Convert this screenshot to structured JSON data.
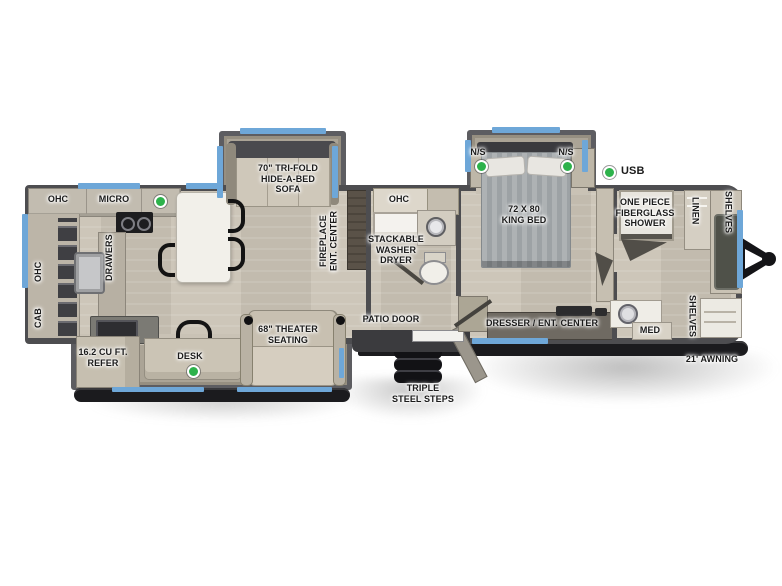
{
  "colors": {
    "window": "#6ea7d8",
    "indicator": "#2db24b",
    "wall": "#4d4d50",
    "chassis": "#1b1b1e"
  },
  "legend": {
    "usb": "USB"
  },
  "exterior": {
    "awning": "21' AWNING",
    "steps": "TRIPLE\nSTEEL STEPS",
    "patio_door": "PATIO DOOR"
  },
  "kitchen": {
    "ohc_top": "OHC",
    "micro": "MICRO",
    "ohc_side": "OHC",
    "cab": "CAB",
    "drawers": "DRAWERS",
    "refer": "16.2 CU FT.\nREFER",
    "desk": "DESK"
  },
  "living": {
    "sofa": "70\" TRI-FOLD\nHIDE-A-BED\nSOFA",
    "fireplace": "FIREPLACE\nENT. CENTER",
    "theater": "68\" THEATER\nSEATING"
  },
  "bath": {
    "ohc": "OHC",
    "washer": "STACKABLE\nWASHER\nDRYER"
  },
  "bedroom": {
    "bed": "72 X 80\nKING BED",
    "ns_left": "N/S",
    "ns_right": "N/S",
    "dresser": "DRESSER / ENT. CENTER"
  },
  "front_bath": {
    "shower": "ONE PIECE\nFIBERGLASS\nSHOWER",
    "linen": "LINEN",
    "shelves_top": "SHELVES",
    "shelves_bottom": "SHELVES",
    "med": "MED"
  }
}
